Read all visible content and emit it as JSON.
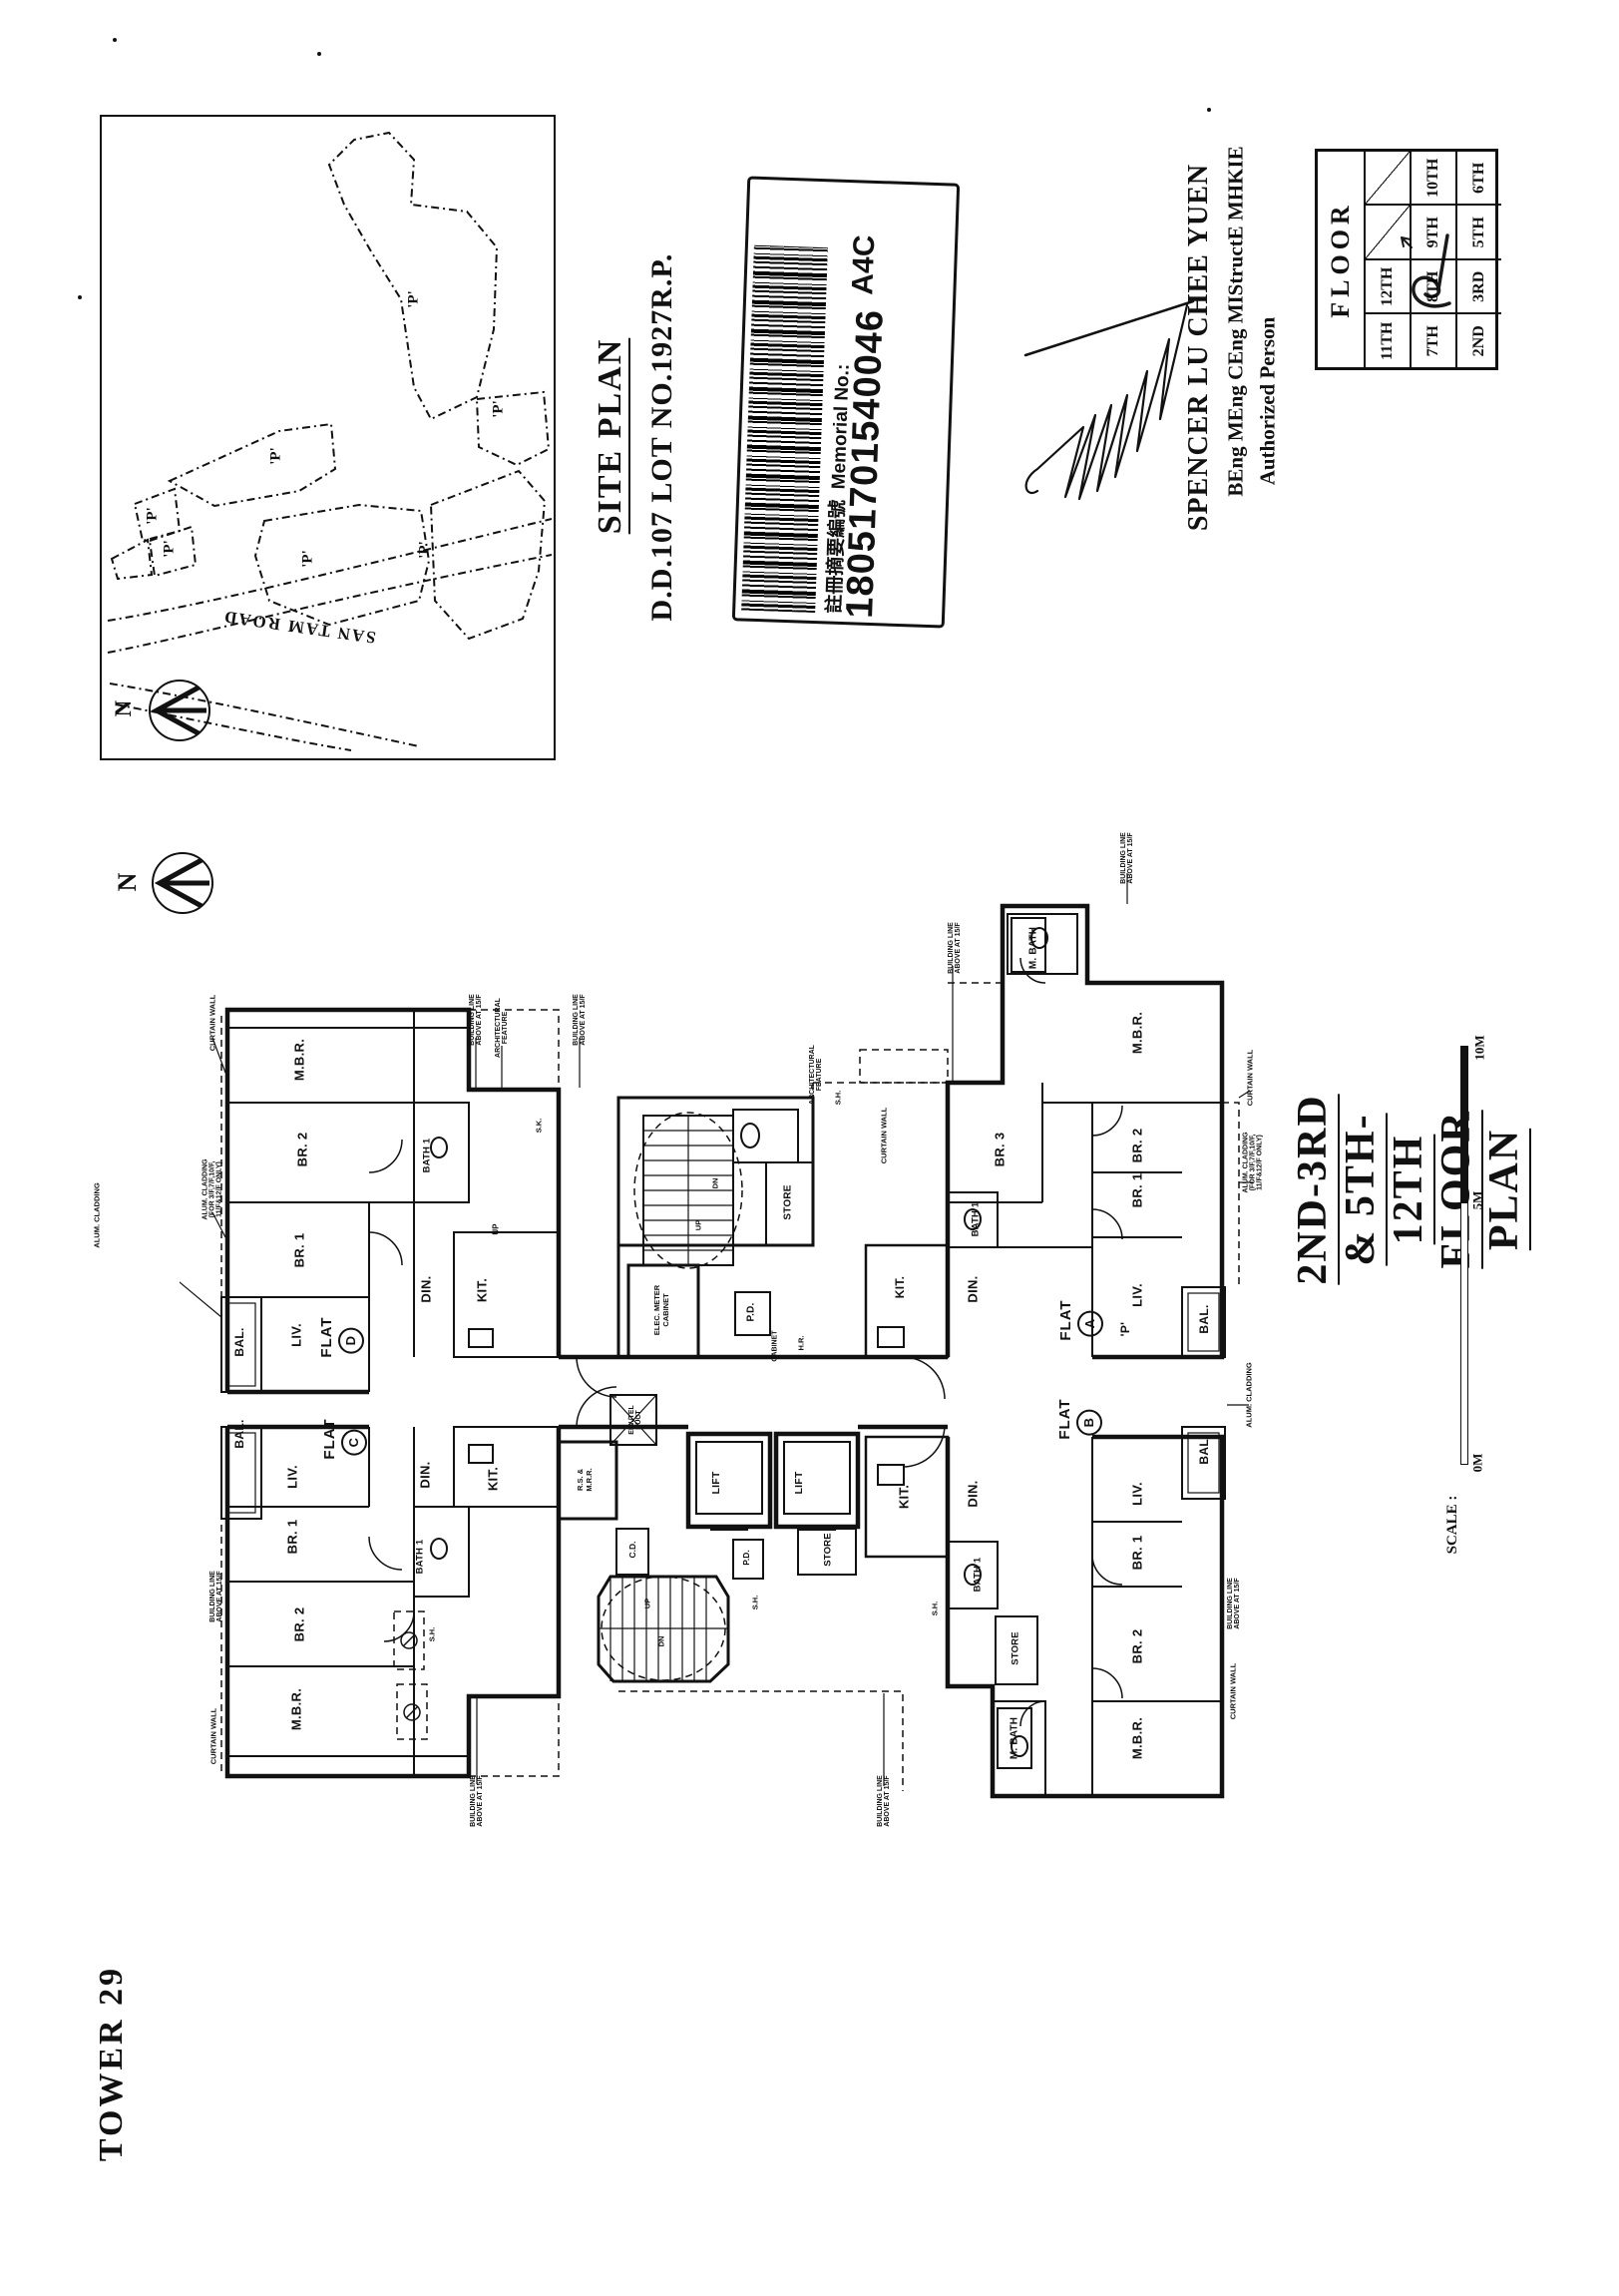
{
  "sheet": {
    "tower_label": "TOWER 29"
  },
  "site_plan": {
    "title": "SITE PLAN",
    "lot": "D.D.107 LOT NO.1927R.P.",
    "road": "SAN TAM ROAD",
    "parcel_label": "'P'",
    "north": "N"
  },
  "barcode": {
    "label": "註冊摘要編號  Memorial No.:",
    "number": "18051701540046",
    "code": "A4C"
  },
  "signature": {
    "name": "SPENCER LU CHEE YUEN",
    "qualifications": "BEng MEng CEng MIStructE MHKIE",
    "role": "Authorized Person"
  },
  "floor_table": {
    "header": "FLOOR",
    "rows": [
      [
        "11TH",
        "12TH",
        "",
        ""
      ],
      [
        "7TH",
        "8TH",
        "9TH",
        "10TH"
      ],
      [
        "2ND",
        "3RD",
        "5TH",
        "6TH"
      ]
    ],
    "marked_floor": "8TH"
  },
  "plan": {
    "title": "2ND-3RD & 5TH-12TH FLOOR PLAN",
    "north": "N",
    "flat_word": "FLAT",
    "flat_letters": {
      "a": "A",
      "b": "B",
      "c": "C",
      "d": "D"
    },
    "scale": {
      "label": "SCALE :",
      "m0": "0M",
      "m5": "5M",
      "m10": "10M"
    },
    "labels": [
      "M.B.R.",
      "BR. 2",
      "BR. 1",
      "LIV.",
      "BAL.",
      "DIN.",
      "KIT.",
      "BATH 1",
      "UP",
      "CURTAIN WALL",
      "ALUM. CLADDING\n(FOR 3/F,7/F,10/F,\n11/F&12/F ONLY)",
      "BUILDING LINE\nABOVE AT 15/F",
      "ARCHITECTURAL\nFEATURE",
      "BUILDING LINE\nABOVE AT 15/F",
      "S.K.",
      "ELEC. METER\nCABINET",
      "STORE",
      "P.D.",
      "CABINET",
      "H.R.",
      "DN",
      "UP",
      "ARCHITECTURAL\nFEATURE",
      "S.H.",
      "CURTAIN WALL",
      "BUILDING LINE\nABOVE AT 15/F",
      "M. BATH",
      "M.B.R.",
      "BR. 3",
      "BR. 2",
      "BR. 1",
      "BATH 1",
      "DIN.",
      "LIV.",
      "'P'",
      "BAL.",
      "CURTAIN WALL",
      "ALUM. CLADDING\n(FOR 3/F,7/F,10/F,\n11/F&12/F ONLY)",
      "BUILDING LINE\nABOVE AT 15/F",
      "KIT.",
      "ELV./TEL\nDUCT",
      "LIFT",
      "LIFT",
      "R.S. &\nM.R.R.",
      "C.D.",
      "P.D.",
      "STORE",
      "KIT.",
      "UP",
      "DN",
      "S.H.",
      "S.H.",
      "BAL.",
      "LIV.",
      "BR. 1",
      "BR. 2",
      "M.B.R.",
      "DIN.",
      "KIT.",
      "BATH 1",
      "S.H.",
      "BUILDING LINE\nABOVE AT 15/F",
      "CURTAIN WALL",
      "BUILDING LINE\nABOVE AT 15/F",
      "DIN.",
      "BAL.",
      "LIV.",
      "BR. 1",
      "BR. 2",
      "M.B.R.",
      "BATH 1",
      "STORE",
      "M. BATH",
      "ALUM. CLADDING",
      "BUILDING LINE\nABOVE AT 15/F",
      "CURTAIN WALL",
      "BUILDING LINE\nABOVE AT 15/F",
      "ALUM. CLADDING"
    ]
  }
}
